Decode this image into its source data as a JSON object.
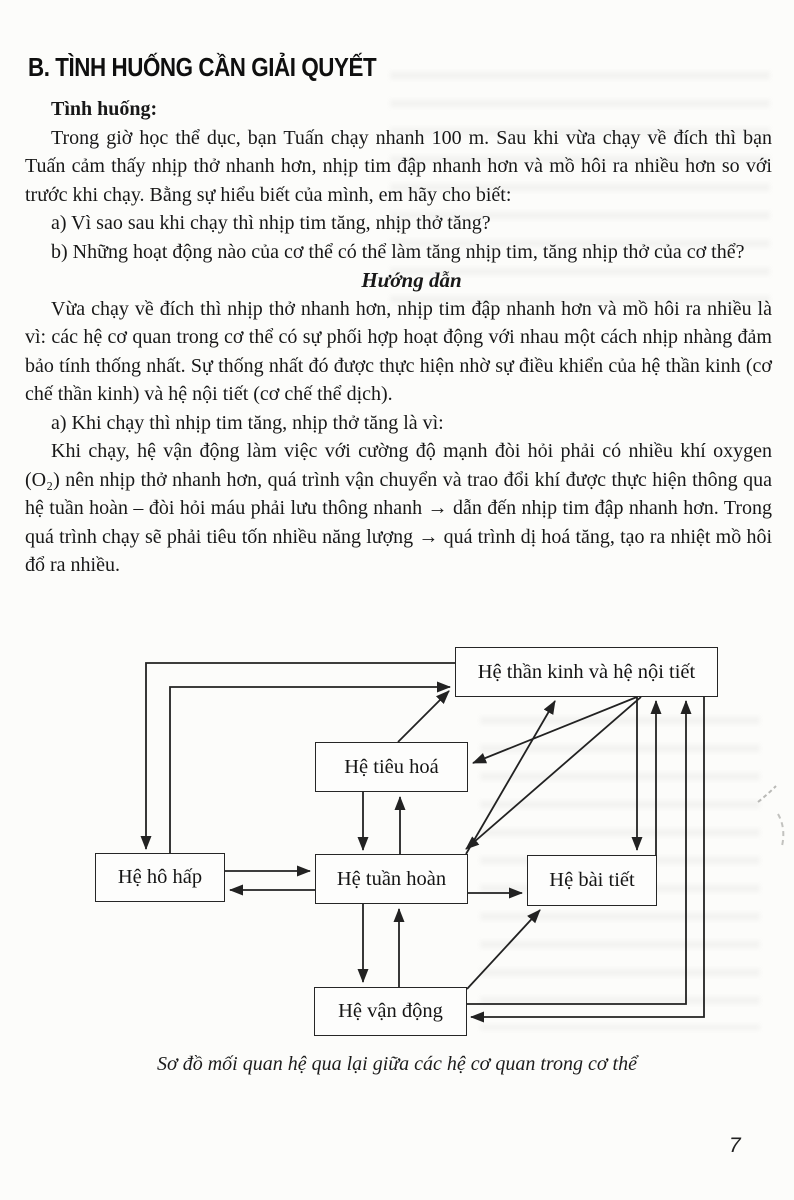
{
  "header": {
    "section_title": "B. TÌNH HUỐNG CẦN GIẢI QUYẾT"
  },
  "situation": {
    "label": "Tình huống:",
    "intro": "Trong giờ học thể dục, bạn Tuấn chạy nhanh 100 m. Sau khi vừa chạy về đích thì bạn Tuấn cảm thấy nhịp thở nhanh hơn, nhịp tim đập nhanh hơn và mồ hôi ra nhiều hơn so với trước khi chạy. Bằng sự hiểu biết của mình, em hãy cho biết:",
    "question_a": "a) Vì sao sau khi chạy thì nhịp tim tăng, nhịp thở tăng?",
    "question_b": "b) Những hoạt động nào của cơ thể có thể làm tăng nhịp tim, tăng nhịp thở của cơ thể?"
  },
  "guide": {
    "heading": "Hướng dẫn",
    "paragraph_1": "Vừa chạy về đích thì nhịp thở nhanh hơn, nhịp tim đập nhanh hơn và mồ hôi ra nhiều là vì: các hệ cơ quan trong cơ thể có sự phối hợp hoạt động với nhau một cách nhịp nhàng đảm bảo tính thống nhất. Sự thống nhất đó được thực hiện nhờ sự điều khiển của hệ thần kinh (cơ chế thần kinh) và hệ nội tiết (cơ chế thể dịch).",
    "answer_a_label": "a) Khi chạy thì nhịp tim tăng, nhịp thở tăng là vì:",
    "answer_a_body": "Khi chạy, hệ vận động làm việc với cường độ mạnh đòi hỏi phải có nhiều khí oxygen (O₂) nên nhịp thở nhanh hơn, quá trình vận chuyển và trao đổi khí được thực hiện thông qua hệ tuần hoàn – đòi hỏi máu phải lưu thông nhanh → dẫn đến nhịp tim đập nhanh hơn. Trong quá trình chạy sẽ phải tiêu tốn nhiều năng lượng → quá trình dị hoá tăng, tạo ra nhiệt mồ hôi đổ ra nhiều."
  },
  "diagram": {
    "caption": "Sơ đồ mối quan hệ qua lại giữa các hệ cơ quan trong cơ thể",
    "line_color": "#222222",
    "nodes": [
      {
        "id": "nervous",
        "label": "Hệ thần kinh và hệ nội tiết",
        "x": 455,
        "y": 647,
        "w": 263,
        "h": 50
      },
      {
        "id": "digestive",
        "label": "Hệ tiêu hoá",
        "x": 315,
        "y": 742,
        "w": 153,
        "h": 50
      },
      {
        "id": "respiratory",
        "label": "Hệ hô hấp",
        "x": 95,
        "y": 853,
        "w": 130,
        "h": 49
      },
      {
        "id": "circulatory",
        "label": "Hệ tuần hoàn",
        "x": 315,
        "y": 854,
        "w": 153,
        "h": 50
      },
      {
        "id": "excretory",
        "label": "Hệ bài tiết",
        "x": 527,
        "y": 855,
        "w": 130,
        "h": 51
      },
      {
        "id": "motor",
        "label": "Hệ vận động",
        "x": 314,
        "y": 987,
        "w": 153,
        "h": 49
      }
    ],
    "edges": [
      {
        "from": "nervous",
        "to": "respiratory",
        "points": [
          [
            455,
            663
          ],
          [
            146,
            663
          ],
          [
            146,
            849
          ]
        ]
      },
      {
        "from": "respiratory",
        "to": "nervous",
        "points": [
          [
            170,
            853
          ],
          [
            170,
            687
          ],
          [
            450,
            687
          ]
        ]
      },
      {
        "from": "respiratory",
        "to": "circulatory",
        "points": [
          [
            225,
            871
          ],
          [
            310,
            871
          ]
        ]
      },
      {
        "from": "circulatory",
        "to": "respiratory",
        "points": [
          [
            315,
            890
          ],
          [
            230,
            890
          ]
        ]
      },
      {
        "from": "digestive",
        "to": "circulatory",
        "points": [
          [
            363,
            792
          ],
          [
            363,
            850
          ]
        ]
      },
      {
        "from": "circulatory",
        "to": "digestive",
        "points": [
          [
            400,
            854
          ],
          [
            400,
            797
          ]
        ]
      },
      {
        "from": "circulatory",
        "to": "motor",
        "points": [
          [
            363,
            904
          ],
          [
            363,
            982
          ]
        ]
      },
      {
        "from": "motor",
        "to": "circulatory",
        "points": [
          [
            399,
            987
          ],
          [
            399,
            909
          ]
        ]
      },
      {
        "from": "circulatory",
        "to": "excretory",
        "points": [
          [
            468,
            893
          ],
          [
            522,
            893
          ]
        ]
      },
      {
        "from": "motor",
        "to": "excretory",
        "points": [
          [
            467,
            989
          ],
          [
            540,
            910
          ]
        ]
      },
      {
        "from": "digestive",
        "to": "nervous",
        "points": [
          [
            398,
            742
          ],
          [
            449,
            691
          ]
        ]
      },
      {
        "from": "nervous",
        "to": "digestive",
        "points": [
          [
            637,
            697
          ],
          [
            473,
            763
          ]
        ]
      },
      {
        "from": "circulatory",
        "to": "nervous",
        "points": [
          [
            466,
            854
          ],
          [
            555,
            701
          ]
        ]
      },
      {
        "from": "nervous",
        "to": "circulatory",
        "points": [
          [
            641,
            697
          ],
          [
            466,
            849
          ]
        ]
      },
      {
        "from": "nervous",
        "to": "excretory",
        "points": [
          [
            637,
            697
          ],
          [
            637,
            850
          ]
        ]
      },
      {
        "from": "excretory",
        "to": "nervous",
        "points": [
          [
            656,
            855
          ],
          [
            656,
            701
          ]
        ]
      },
      {
        "from": "motor",
        "to": "nervous",
        "points": [
          [
            467,
            1004
          ],
          [
            686,
            1004
          ],
          [
            686,
            701
          ]
        ]
      },
      {
        "from": "nervous",
        "to": "motor",
        "points": [
          [
            704,
            697
          ],
          [
            704,
            1017
          ],
          [
            471,
            1017
          ]
        ]
      }
    ]
  },
  "footer": {
    "page_number": "7"
  }
}
